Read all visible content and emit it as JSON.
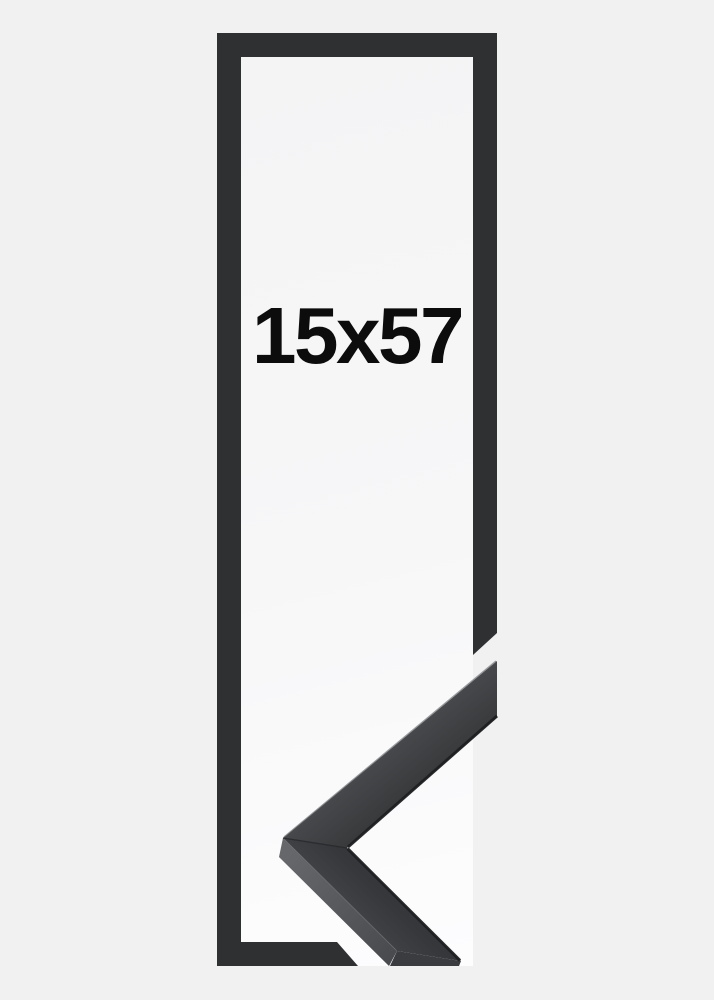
{
  "product": {
    "size_label": "15x57"
  },
  "colors": {
    "background": "#f1f1f2",
    "inner_area": "#f7f7f8",
    "frame_outline": "#2e3032",
    "label_text": "#0c0c0d",
    "corner_rail_face": "#3e4043",
    "corner_rail_side": "#5a5c60",
    "corner_rail_inner_lip": "#1d1f21",
    "corner_rail_highlight": "#6f7276"
  }
}
